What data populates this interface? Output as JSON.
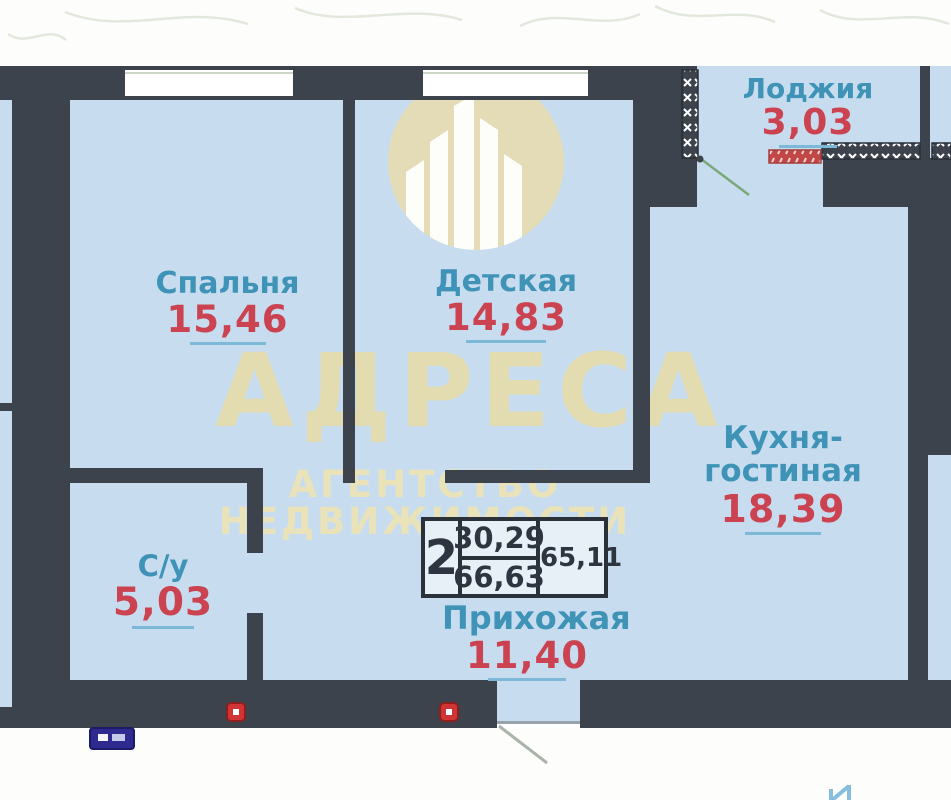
{
  "watermark": {
    "title": "АДРЕСА",
    "subtitle": "АГЕНТСТВО НЕДВИЖИМОСТИ"
  },
  "rooms": [
    {
      "name": "Спальня",
      "area": "15,46"
    },
    {
      "name": "Детская",
      "area": "14,83"
    },
    {
      "name": "Лоджия",
      "area": "3,03"
    },
    {
      "name": "Кухня-гостиная",
      "area": "18,39"
    },
    {
      "name": "С/у",
      "area": "5,03"
    },
    {
      "name": "Прихожая",
      "area": "11,40"
    }
  ],
  "info_table": {
    "rooms_count": "2",
    "value_top": "30,29",
    "value_bottom": "66,63",
    "value_right": "65,11"
  },
  "colors": {
    "wall": "#3c434d",
    "floor": "#c7ddef",
    "room_label": "#3e93b6",
    "area_value": "#cb4250",
    "area_underline": "#7cb8d8",
    "watermark_beige": "#e9dcab",
    "door_swing_green": "#79a979",
    "door_marker_red": "#d03434",
    "bottom_marker_blue": "#2e2a8f"
  }
}
